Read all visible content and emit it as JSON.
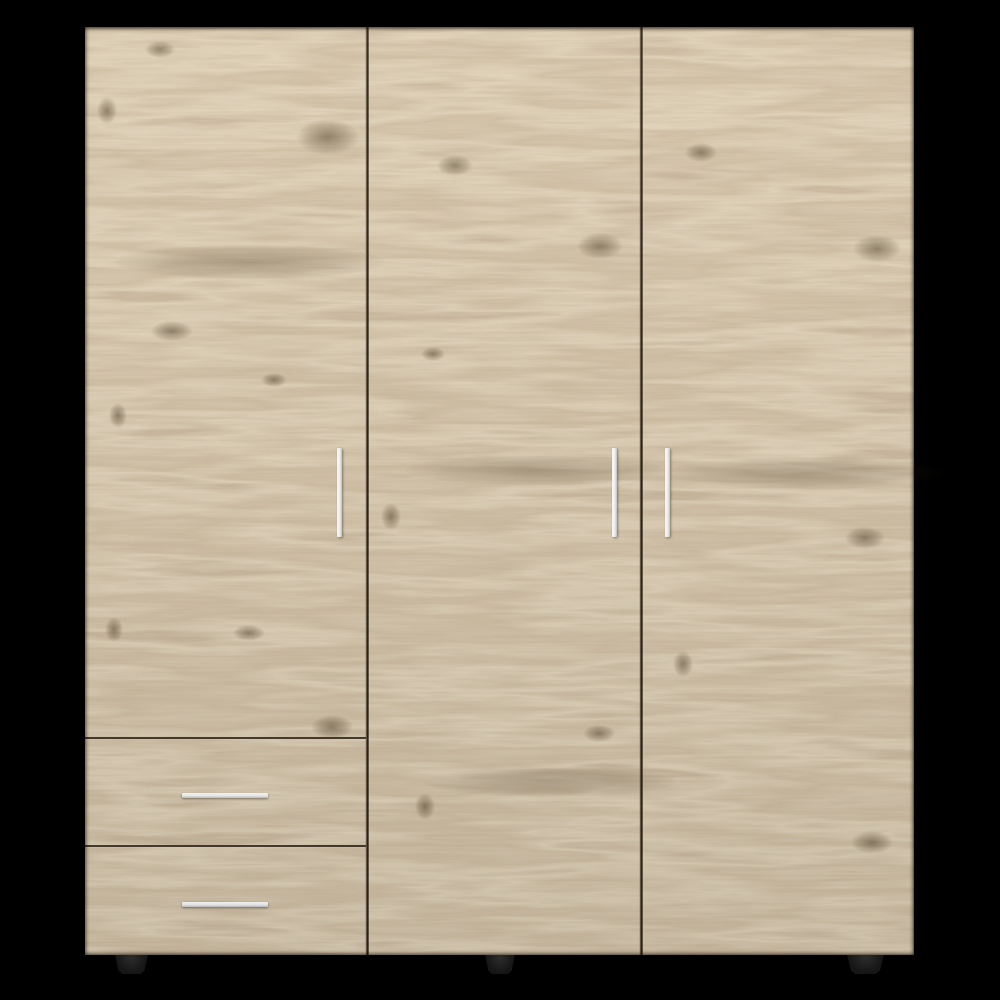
{
  "scene": {
    "type": "product-photo",
    "subject": "Three-door wardrobe armoire with two lower drawers, light oak woodgrain finish, vertical and horizontal silver bar handles, black tapered feet, on a black background",
    "background_color": "#000000"
  },
  "colors": {
    "wood_base": "#b49b74",
    "wood_light": "#c8ae85",
    "wood_dark": "#8e7655",
    "panel_gap": "#2e2517",
    "handle_light": "#ffffff",
    "handle_dark": "#c4c4c4",
    "foot": "#161616"
  },
  "furniture": {
    "doors": 3,
    "drawers": 2,
    "handles": 5,
    "feet_visible": 3
  }
}
